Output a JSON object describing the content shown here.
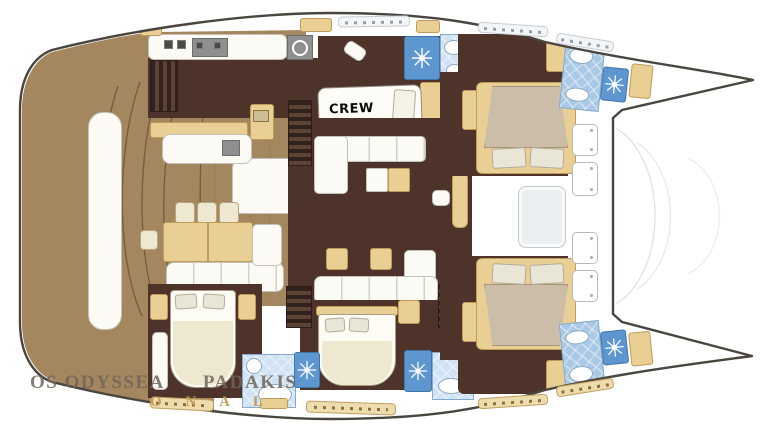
{
  "title": "Catamaran yacht interior deck plan",
  "labels": {
    "crew_cabin": "CREW"
  },
  "watermark": {
    "part1": "OS ODYSSEA",
    "part2": "PADAKIS",
    "line2": "O N A L"
  },
  "colors": {
    "hull_outline": "#4a463f",
    "deck_wood": "#a5875f",
    "cabin_floor": "#4e332b",
    "furniture_tan": "#e9cf93",
    "furniture_cream": "#efe8d0",
    "furniture_white": "#fbfaf4",
    "bath_tile_light": "#cfe3f4",
    "bath_tile_blue": "#a9c9e6",
    "bath_shower_blue": "#5e97cf",
    "mattress_taupe": "#cbbda8"
  },
  "icons": {
    "shower": "starburst-jets",
    "toilet": "oval-bowl",
    "sink": "oval-basin",
    "stove": "cooktop-grid",
    "vent": "round-fan",
    "deck_hatch": "rounded-square-with-dots"
  }
}
